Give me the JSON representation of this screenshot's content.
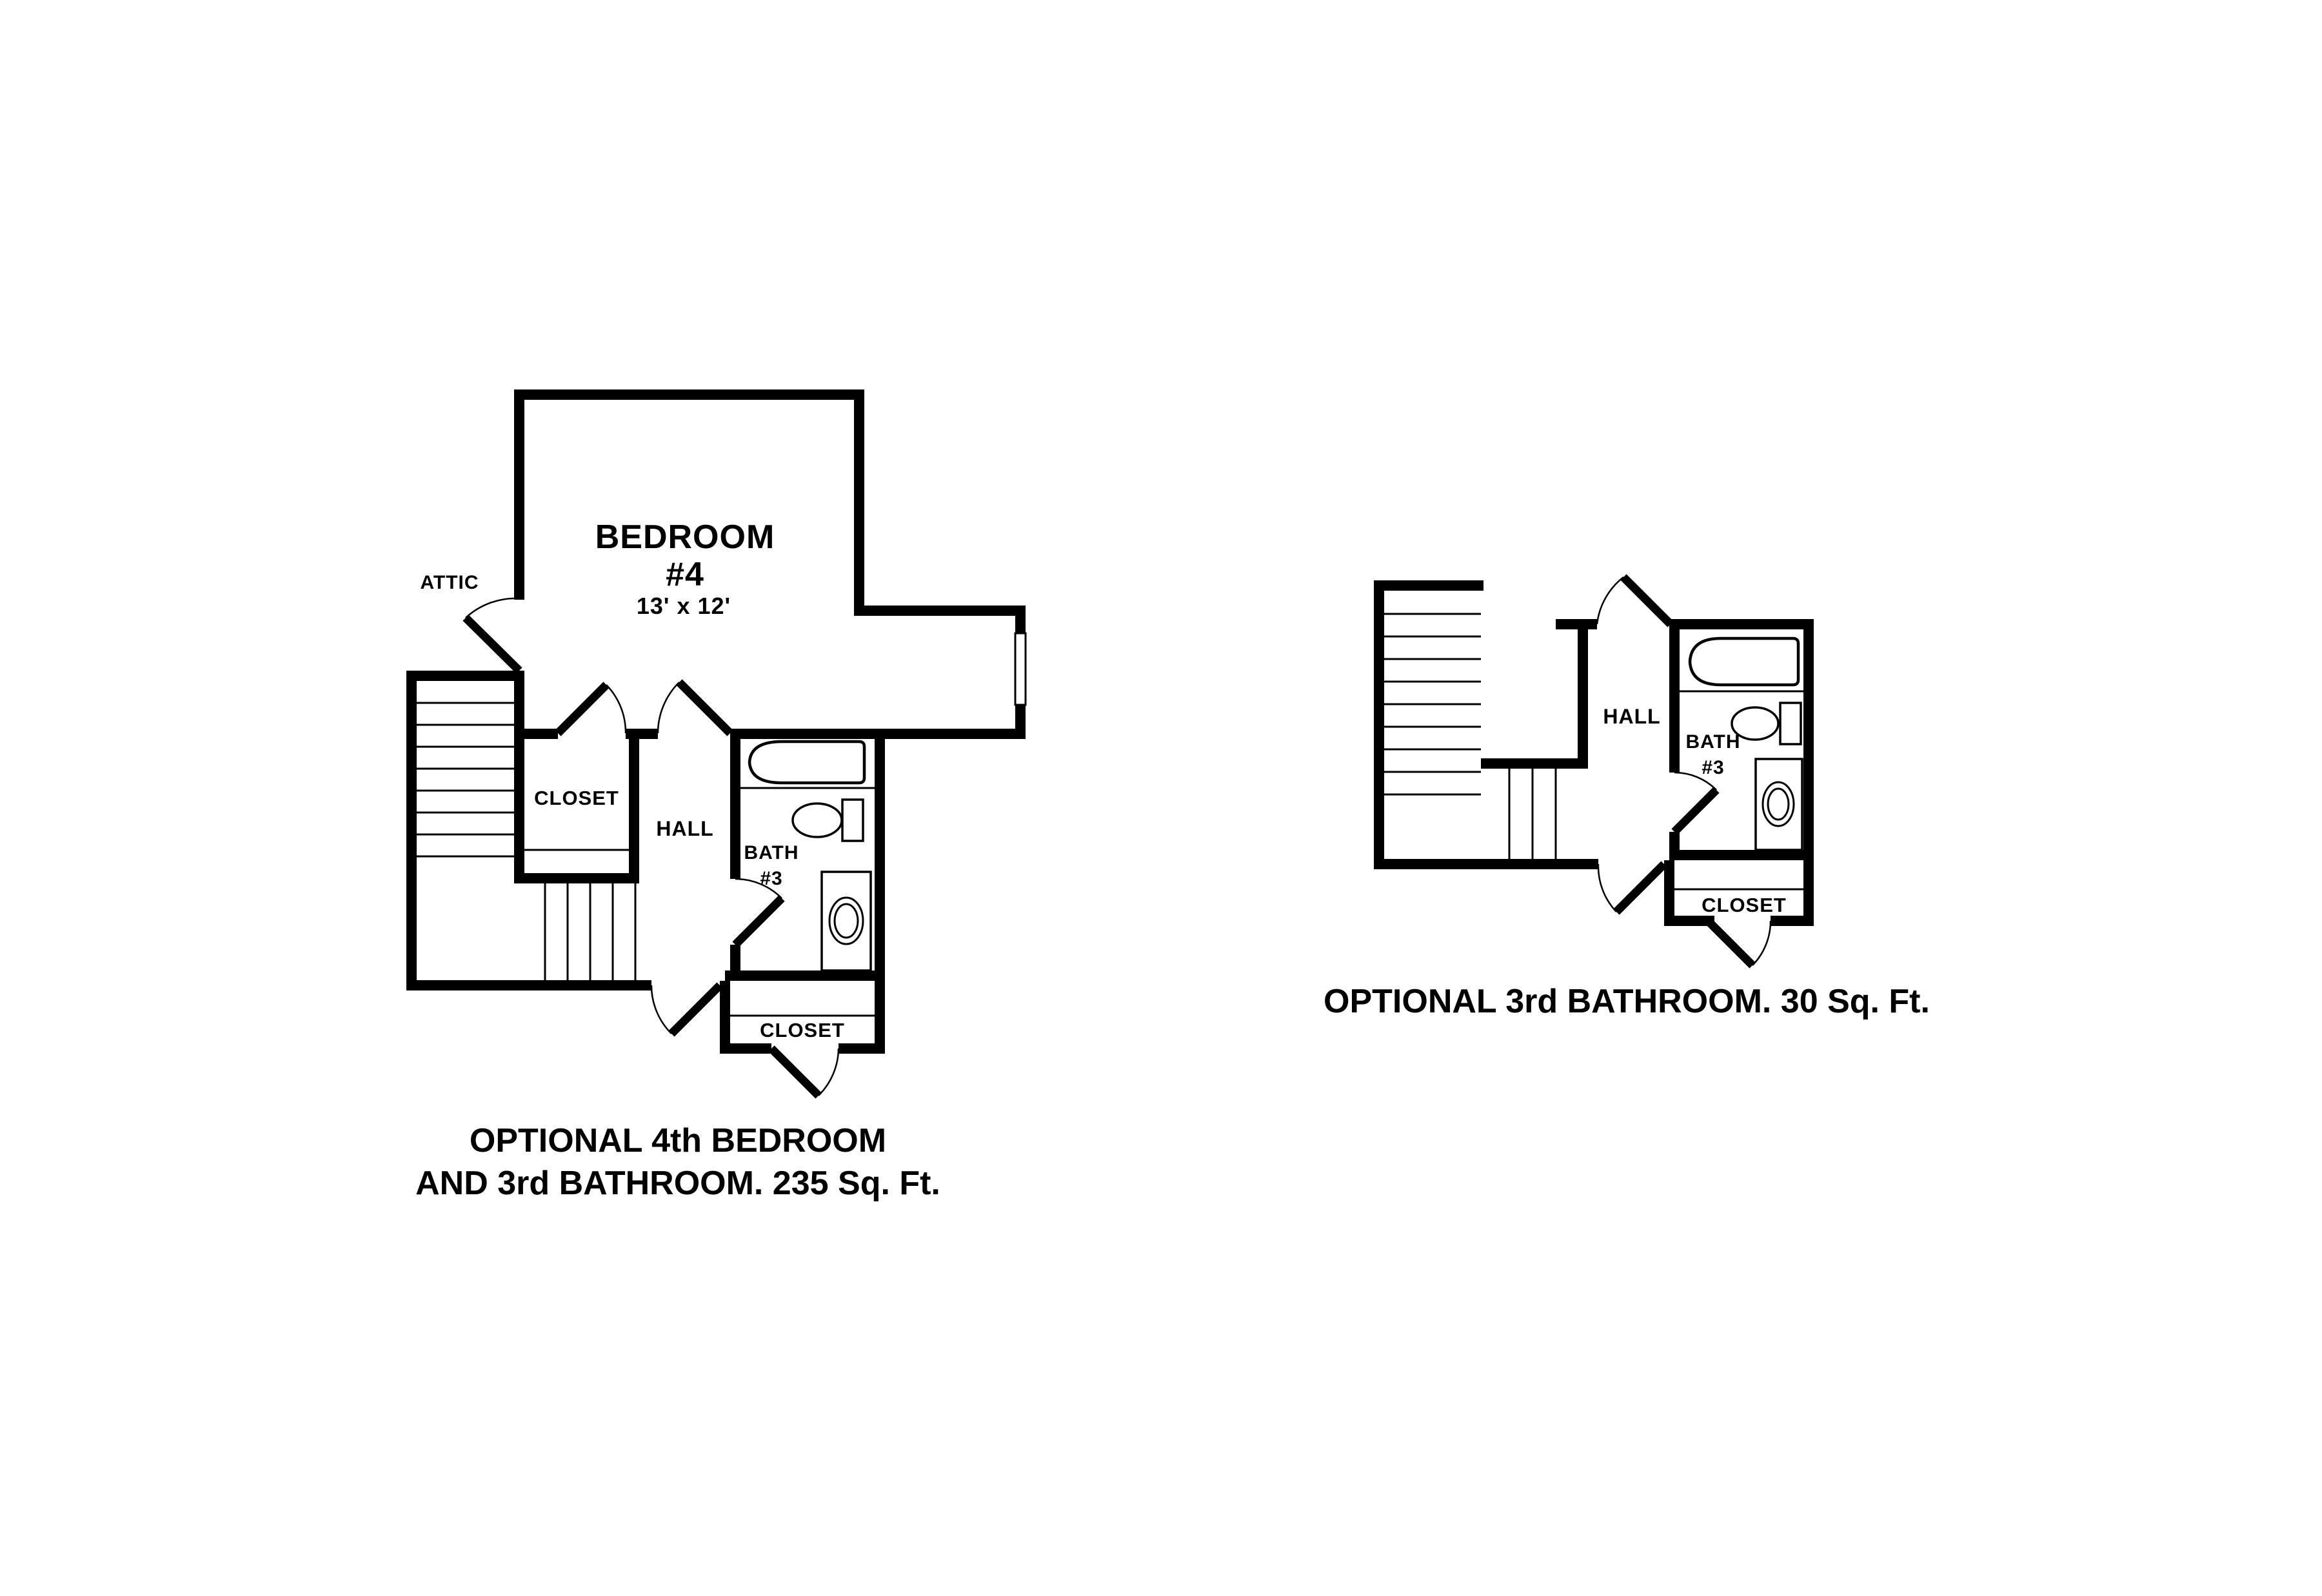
{
  "colors": {
    "ink": "#000000",
    "background": "#ffffff"
  },
  "plans": {
    "left": {
      "labels": {
        "attic": "ATTIC",
        "bedroom_name": "BEDROOM",
        "bedroom_number": "#4",
        "bedroom_dims": "13' x 12'",
        "closet_upper": "CLOSET",
        "hall": "HALL",
        "bath_line1": "BATH",
        "bath_line2": "#3",
        "closet_lower": "CLOSET"
      },
      "caption": {
        "line1": "OPTIONAL 4th BEDROOM",
        "line2": "AND 3rd BATHROOM. 235 Sq. Ft."
      }
    },
    "right": {
      "labels": {
        "hall": "HALL",
        "bath_line1": "BATH",
        "bath_line2": "#3",
        "closet": "CLOSET"
      },
      "caption": {
        "line1": "OPTIONAL 3rd BATHROOM. 30 Sq. Ft."
      }
    }
  }
}
